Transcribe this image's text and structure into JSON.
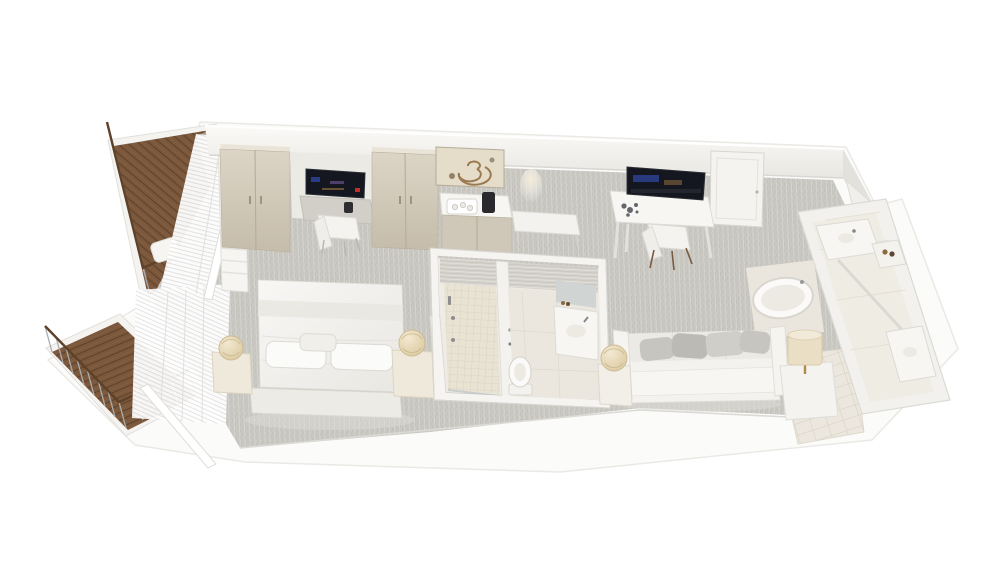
{
  "scene": {
    "background": "#ffffff"
  },
  "colors": {
    "background": "#ffffff",
    "slab": "#fbfbfa",
    "slab_edge": "#e9e7e3",
    "wall": "#fbfaf8",
    "wall_shade": "#e9e7e2",
    "wall_side": "#e3e1dc",
    "door": "#f4f3f0",
    "carpet_base": "#cac8c2",
    "carpet_dark": "#bfbdb6",
    "carpet_light": "#d8d6d0",
    "wood": "#7b583c",
    "wood_dark": "#5e4129",
    "curtain_white": "#fefefe",
    "curtain_shade": "#e4e3e1",
    "wardrobe_hi": "#dcd5c6",
    "wardrobe_lo": "#c5bcaa",
    "linen_hi": "#f8f7f5",
    "linen_lo": "#e9e7e2",
    "lamp_hi": "#f3e9d2",
    "lamp_lo": "#d8c69a",
    "lamp_drum": "#eadfc5",
    "gold": "#b08d46",
    "glow": "#f5ecd8",
    "tv_dark": "#14171f",
    "tv_blue": "#2b3f8f",
    "tv_red": "#c03028",
    "desk_gray": "#d2cfc8",
    "counter": "#f7f6f3",
    "cabinet": "#cfc7b7",
    "bench": "#f3f2ee",
    "tile_small": "#e9e3d4",
    "tile_line": "#d7cfbe",
    "bath_floor": "#ebe7de",
    "marble": "#d5d2cb",
    "marble_line": "#c6c3bc",
    "fixture": "#fbfaf8",
    "fixture_inner": "#eceae3",
    "fixture_edge": "#d6d3cc",
    "mirror": "#d0d4d3",
    "sofa_white": "#f3f2ee",
    "cushion_a": "#c7c5c0",
    "cushion_b": "#bcbab5",
    "cushion_c": "#d0cec9",
    "glass": "#b9c2c3",
    "chair_wood": "#7a5a40",
    "block": "#f2f1ed",
    "block_floor": "#efece4",
    "art_bg": "#e5dcca",
    "art_stroke": "#9a7a50",
    "art_dark": "#6f5a3e",
    "rail": "#a9adaf"
  },
  "inventory": {
    "balcony_upper": [
      "wood-deck",
      "glass-railing",
      "lounge-chairs",
      "coffee-table"
    ],
    "balcony_lower": [
      "wood-deck",
      "glass-railing"
    ],
    "bedroom": [
      "double-bed",
      "pillows",
      "nightstand-left",
      "nightstand-right",
      "sphere-lamp-left",
      "sphere-lamp-right",
      "wardrobe-left",
      "wardrobe-right",
      "wall-tv",
      "desk",
      "chair",
      "sheer-curtains"
    ],
    "wall_units": [
      "shell-artwork",
      "minibar-console",
      "coffee-machine",
      "amenity-tray",
      "luggage-bench",
      "entry-door",
      "ceiling-spotlight"
    ],
    "bathroom_center": [
      "walk-in-shower",
      "toilet",
      "vanity-sink",
      "mirror",
      "glass-door"
    ],
    "living_area": [
      "sofa",
      "scatter-cushions",
      "side-table-left",
      "sphere-lamp",
      "side-table-right",
      "drum-lamp",
      "desk",
      "tv",
      "chair"
    ],
    "bathroom_right": [
      "bathtub",
      "vanity-sink",
      "amenity-shelf",
      "toilet",
      "tile-floor"
    ]
  }
}
